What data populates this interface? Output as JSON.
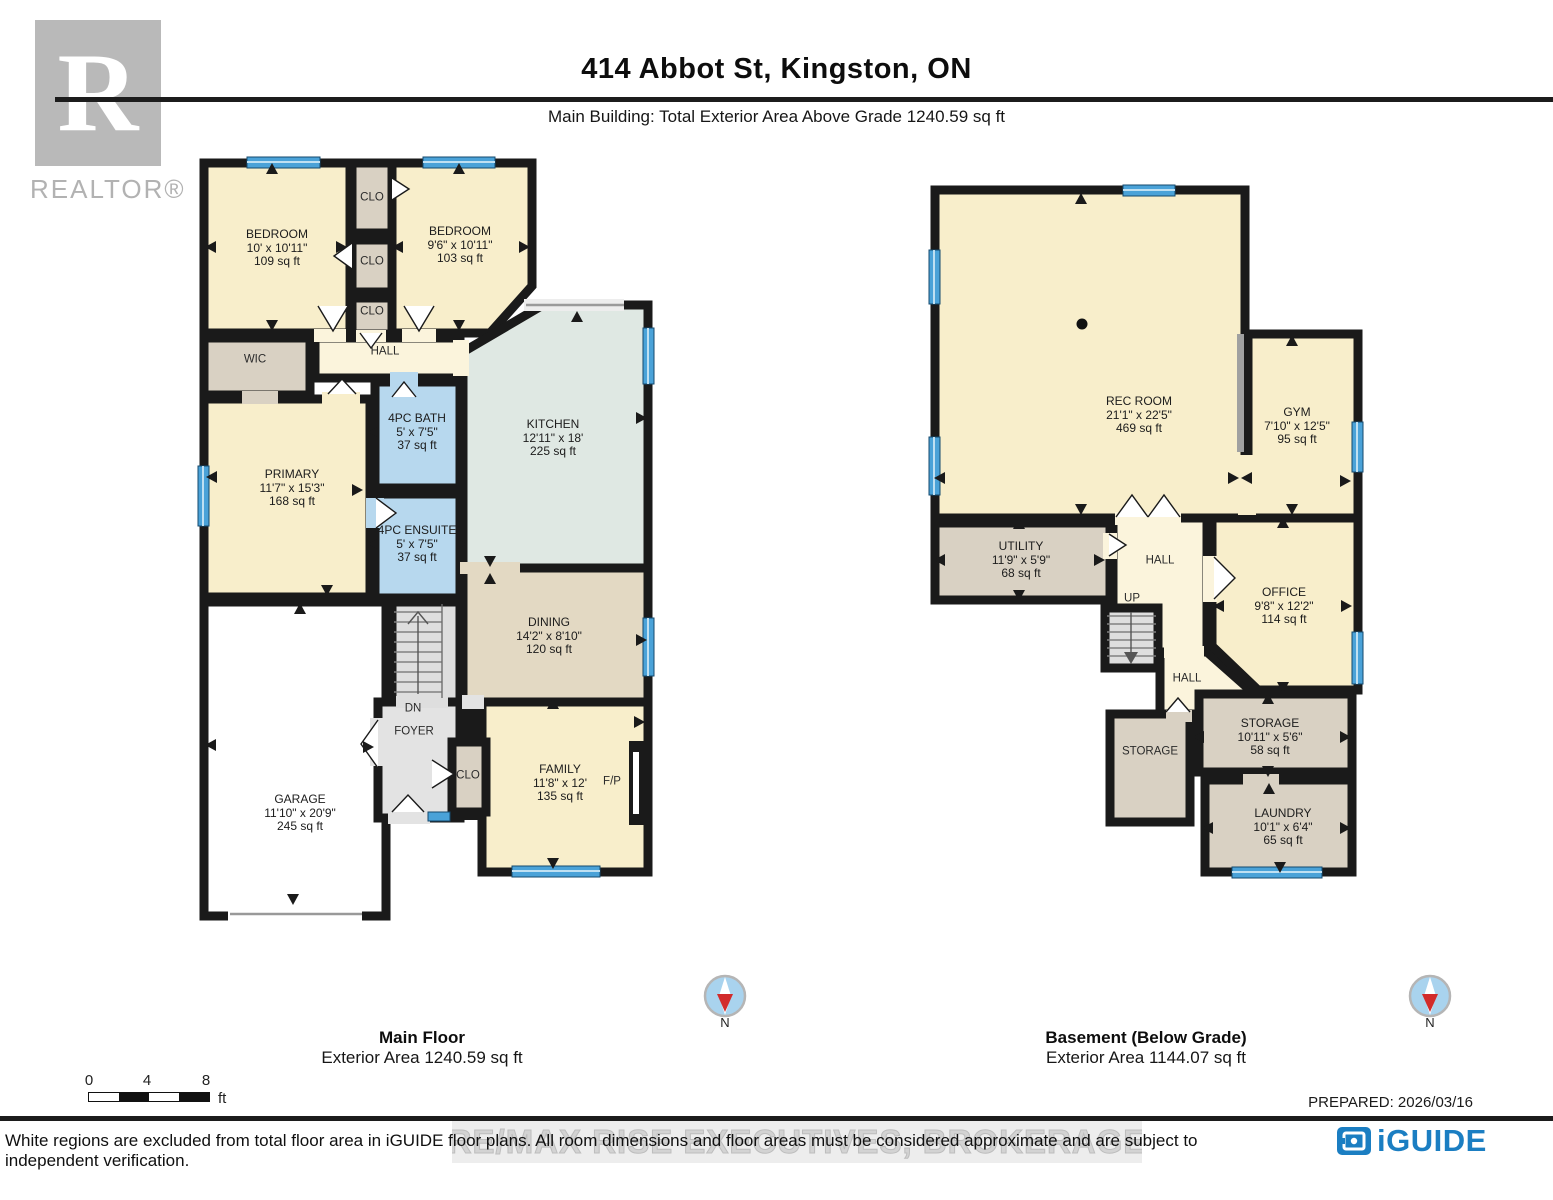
{
  "header": {
    "title": "414 Abbot St, Kingston, ON",
    "subtitle": "Main Building: Total Exterior Area Above Grade 1240.59 sq ft",
    "realtor_wordmark": "REALTOR®",
    "realtor_letter": "R"
  },
  "main_floor": {
    "caption_title": "Main Floor",
    "caption_area": "Exterior Area 1240.59 sq ft",
    "rooms": {
      "bedroom_left": {
        "name": "BEDROOM",
        "dims": "10' x 10'11\"",
        "area": "109 sq ft"
      },
      "bedroom_right": {
        "name": "BEDROOM",
        "dims": "9'6\" x 10'11\"",
        "area": "103 sq ft"
      },
      "closet_top": {
        "name": "CLO"
      },
      "closet_mid": {
        "name": "CLO"
      },
      "closet_bottom": {
        "name": "CLO"
      },
      "wic": {
        "name": "WIC"
      },
      "hall": {
        "name": "HALL"
      },
      "kitchen": {
        "name": "KITCHEN",
        "dims": "12'11\" x 18'",
        "area": "225 sq ft"
      },
      "bath": {
        "name": "4PC BATH",
        "dims": "5' x 7'5\"",
        "area": "37 sq ft"
      },
      "ensuite": {
        "name": "4PC ENSUITE",
        "dims": "5' x 7'5\"",
        "area": "37 sq ft"
      },
      "primary": {
        "name": "PRIMARY",
        "dims": "11'7\" x 15'3\"",
        "area": "168 sq ft"
      },
      "dining": {
        "name": "DINING",
        "dims": "14'2\" x 8'10\"",
        "area": "120 sq ft"
      },
      "family": {
        "name": "FAMILY",
        "dims": "11'8\" x 12'",
        "area": "135 sq ft"
      },
      "garage": {
        "name": "GARAGE",
        "dims": "11'10\" x 20'9\"",
        "area": "245 sq ft"
      },
      "foyer": {
        "name": "FOYER"
      },
      "foyer_closet": {
        "name": "CLO"
      },
      "stairs_down": {
        "name": "DN"
      },
      "fireplace": {
        "name": "F/P"
      }
    }
  },
  "basement": {
    "caption_title": "Basement (Below Grade)",
    "caption_area": "Exterior Area 1144.07 sq ft",
    "rooms": {
      "rec_room": {
        "name": "REC ROOM",
        "dims": "21'1\" x 22'5\"",
        "area": "469 sq ft"
      },
      "gym": {
        "name": "GYM",
        "dims": "7'10\" x 12'5\"",
        "area": "95 sq ft"
      },
      "utility": {
        "name": "UTILITY",
        "dims": "11'9\" x 5'9\"",
        "area": "68 sq ft"
      },
      "office": {
        "name": "OFFICE",
        "dims": "9'8\" x 12'2\"",
        "area": "114 sq ft"
      },
      "hall_upper": {
        "name": "HALL"
      },
      "hall_lower": {
        "name": "HALL"
      },
      "stairs_up": {
        "name": "UP"
      },
      "storage_left": {
        "name": "STORAGE"
      },
      "storage_right": {
        "name": "STORAGE",
        "dims": "10'11\" x 5'6\"",
        "area": "58 sq ft"
      },
      "laundry": {
        "name": "LAUNDRY",
        "dims": "10'1\" x 6'4\"",
        "area": "65 sq ft"
      }
    }
  },
  "compass": {
    "label": "N"
  },
  "scale_bar": {
    "tick_0": "0",
    "tick_4": "4",
    "tick_8": "8",
    "unit": "ft"
  },
  "footer": {
    "prepared": "PREPARED: 2026/03/16",
    "disclaimer": "White regions are excluded from total floor area in iGUIDE floor plans. All room dimensions and floor areas must be considered approximate and are subject to independent verification.",
    "watermark": "RE/MAX RISE EXECUTIVES, BROKERAGE",
    "brand": "iGUIDE"
  },
  "colors": {
    "wall": "#1a1a1a",
    "room_cream": "#f8eecb",
    "hall_cream": "#fbf4dc",
    "dining_tan": "#e3d9c3",
    "gray_tan": "#d9d1c3",
    "bath_blue": "#b7d8ee",
    "kitchen_teal": "#dfe8e3",
    "floor_gray": "#e3e3e3",
    "window_blue": "#4aa2d8",
    "brand_blue": "#1b7ec2",
    "compass_red": "#d22b2b",
    "logo_gray": "#b9b9b9"
  }
}
